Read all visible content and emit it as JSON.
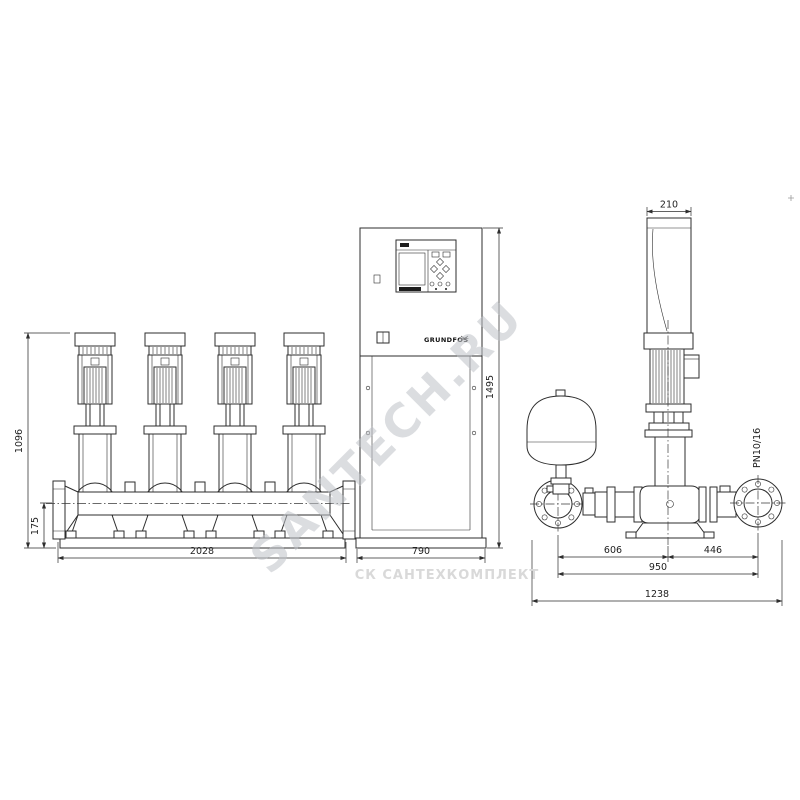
{
  "drawing": {
    "front_view": {
      "dims": {
        "height": "1096",
        "pipe_axis_height": "175",
        "width": "2028"
      }
    },
    "cabinet_view": {
      "dims": {
        "width": "790",
        "height": "1495"
      },
      "brand_logo": "GRUNDFOS"
    },
    "side_view": {
      "dims": {
        "motor_width": "210",
        "suction_span": "606",
        "discharge_span": "446",
        "flange_span": "950",
        "total_width": "1238"
      },
      "pressure_rating": "PN10/16"
    },
    "watermarks": {
      "diagonal": "SANTECH.RU",
      "footer": "СК САНТЕХКОМПЛЕКТ"
    }
  }
}
